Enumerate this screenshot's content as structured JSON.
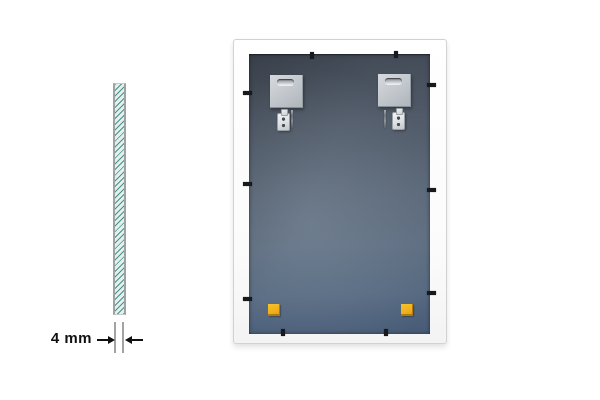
{
  "scene": {
    "background_color": "#ffffff",
    "subject": "mirror glass pane: side cross-section and back view of framed panel"
  },
  "side_view": {
    "name": "glass-cross-section",
    "glass_fill_color": "#e3efed",
    "hatch_color": "#3f8c83",
    "edge_color": "#9ba3a3",
    "dimension": {
      "label": "4 mm",
      "text_color": "#101010",
      "extension_line_color": "#a3a3a3",
      "arrow_color": "#101010"
    }
  },
  "back_view": {
    "name": "frame-back",
    "frame_color": "#fdfdfd",
    "frame_border_color": "#d2d2d2",
    "panel_colors": {
      "top": "#424a56",
      "middle": "#5a6777",
      "bottom": "#475b77"
    },
    "hardware": {
      "plate_color": "#c5cacf",
      "plate_count": 2,
      "screw_count": 2,
      "bracket_count": 2,
      "clip_color": "#17191d",
      "clip_count": 10
    },
    "pads": {
      "color": "#f1b11c",
      "count": 2
    }
  }
}
